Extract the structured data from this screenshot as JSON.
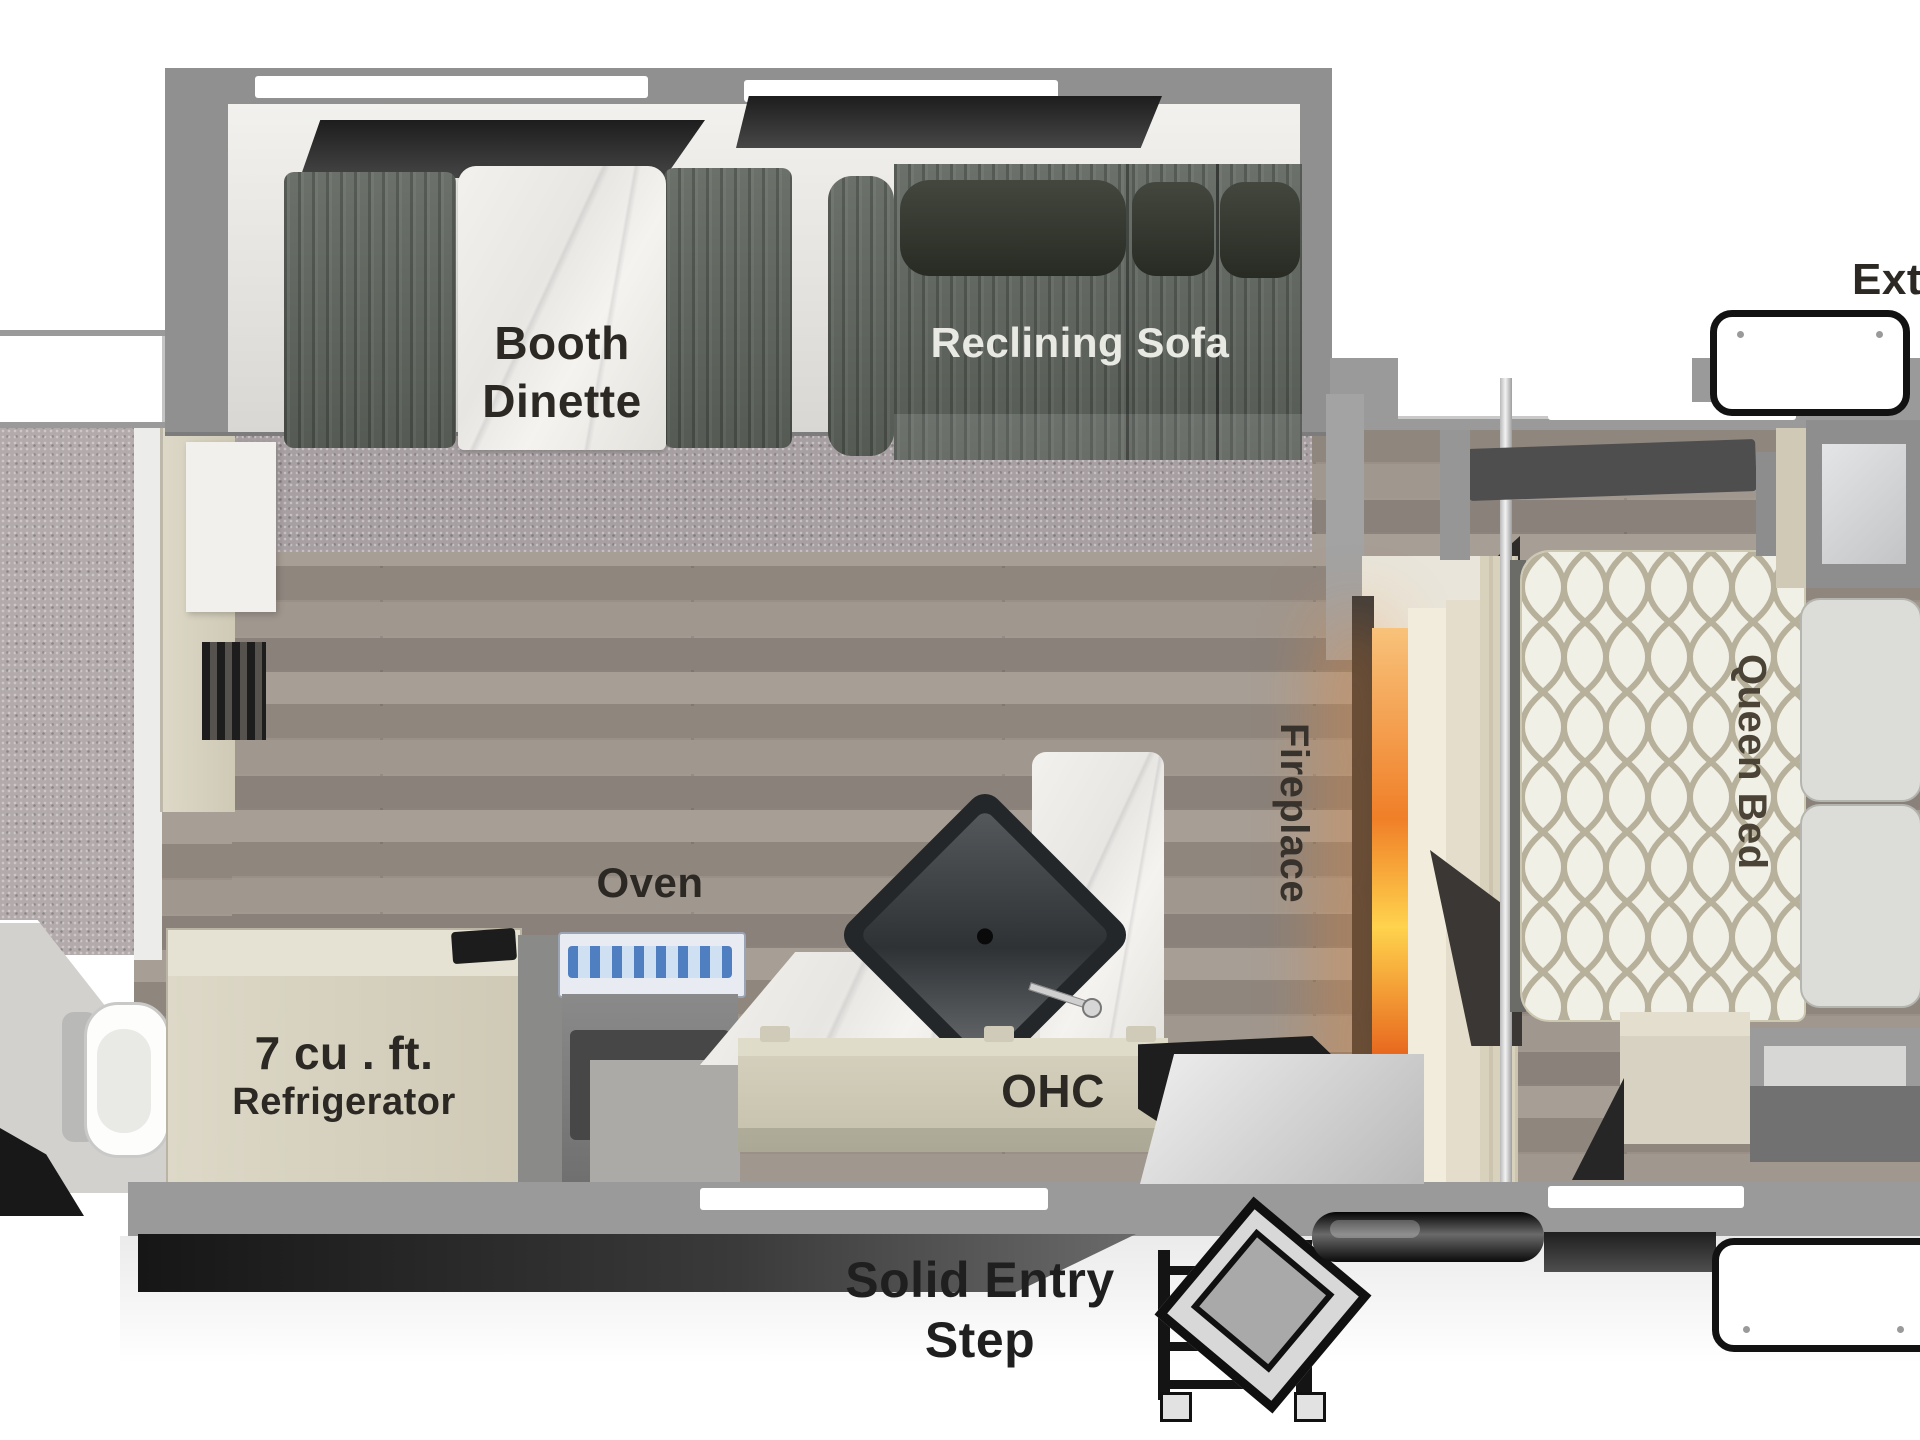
{
  "labels": {
    "booth_line1": "Booth",
    "booth_line2": "Dinette",
    "reclining_sofa": "Reclining Sofa",
    "queen_bed": "Queen Bed",
    "fireplace": "Fireplace",
    "oven": "Oven",
    "fridge_line1": "7 cu . ft.",
    "fridge_line2": "Refrigerator",
    "ohc": "OHC",
    "entry_line1": "Solid Entry",
    "entry_line2": "Step",
    "exterior_partial": "Exte"
  },
  "colors": {
    "wall_gray": "#9a9a9a",
    "carpet": "#a79fa1",
    "wood_floor": "#9b9289",
    "upholstery": "#5f655e",
    "headrest": "#32362c",
    "marble": "#edebe7",
    "cabinet_tan": "#d8d3c2",
    "mattress": "#f1f0e6",
    "fireplace_glow": "#f08a2e",
    "sink": "#2b2f32",
    "cooktop_blue": "#4f7fc0"
  }
}
